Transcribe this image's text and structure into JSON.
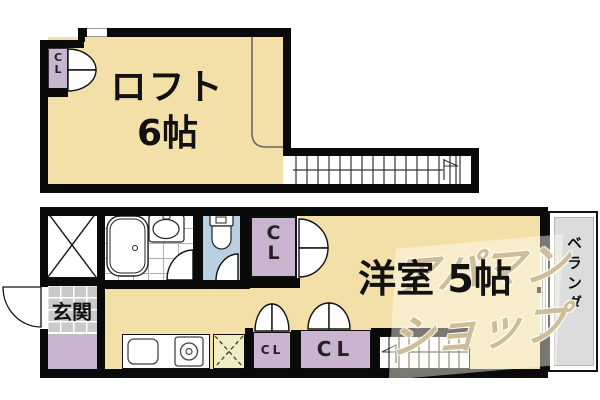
{
  "floorplan": {
    "loft": {
      "room_label": "ロフト",
      "room_size": "6帖",
      "closet_label": "C L"
    },
    "main_floor": {
      "room_label": "洋室 5帖",
      "entrance_label": "玄関",
      "closet_top_label": "C L",
      "closet_small_label": "CL",
      "closet_large_label": "CL",
      "veranda_label": "ベランダ"
    },
    "watermark": {
      "line1": "アパマン",
      "line2": "ショップ"
    },
    "colors": {
      "floor_beige": "#F3E0A9",
      "closet_lavender": "#CAB5D1",
      "toilet_blue": "#B9CFE2",
      "entrance_gray": "#C9C9C9",
      "veranda_gray": "#DCDCDC",
      "fridge_cream": "#F0ECC4",
      "wall_black": "#0A0A0A",
      "watermark_tan": "#B09456"
    }
  }
}
